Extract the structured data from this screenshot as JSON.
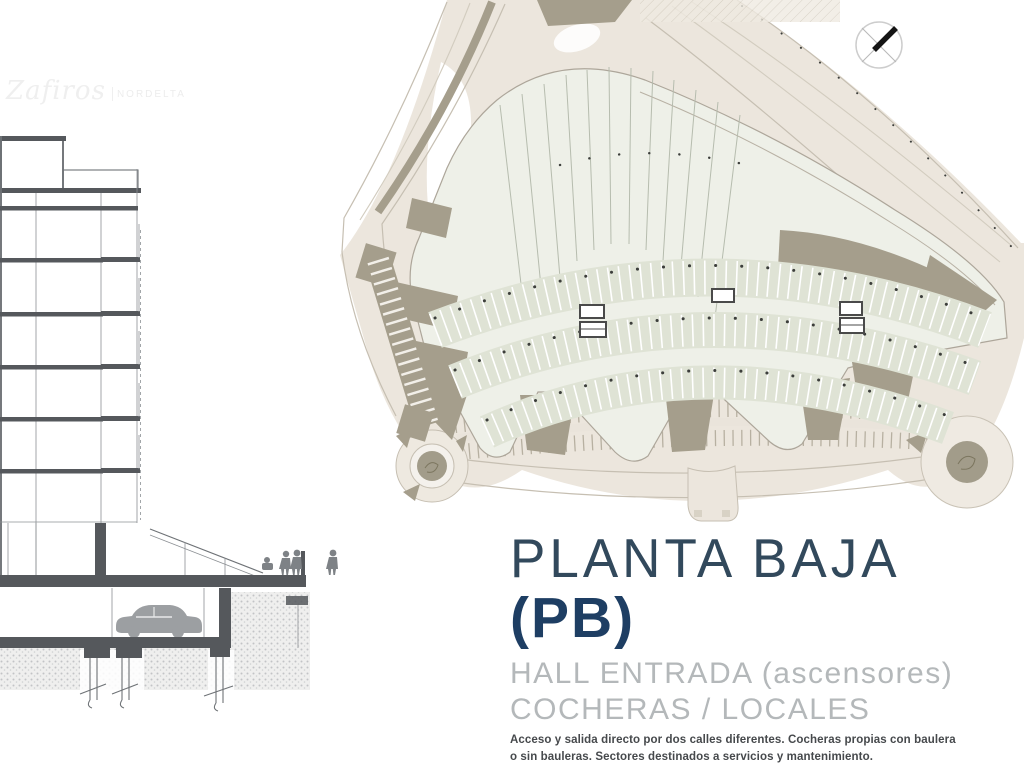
{
  "watermark": {
    "script_text": "Zafiros",
    "brand_text": "NORDELTA"
  },
  "title_block": {
    "title": "PLANTA BAJA",
    "subtitle": "(PB)",
    "feature_line_1": "HALL ENTRADA (ascensores)",
    "feature_line_2": "COCHERAS / LOCALES",
    "description": "Acceso y salida directo por dos calles diferentes. Cocheras propias con baulera o sin bauleras. Sectores destinados a servicios y mantenimiento."
  },
  "icons": {
    "north_arrow": "compass-north-arrow"
  },
  "drawings": {
    "left": "building cross-section with tower floors, balconies, entry hall, underground garage with car, foundation piles",
    "right": "ground-floor site plan with curved avenues, two roundabouts, parking stalls, three elevator cores"
  },
  "colors": {
    "title": "#32495c",
    "subtitle": "#1e3e63",
    "muted": "#b4b8ba",
    "body": "#46494c",
    "road": "#ece6dd",
    "roadedge": "#c6bfb2",
    "terrain": "#a59e8c",
    "building": "#eef0e8",
    "stalls": "#dfe3d5",
    "lineart": "#6e7276",
    "slab": "#55585c"
  }
}
